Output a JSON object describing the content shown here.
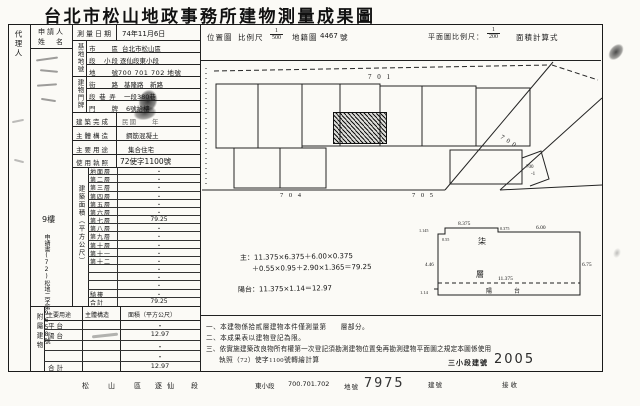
{
  "title": "台北市松山地政事務所建物測量成果圖",
  "margin": {
    "agent_label": "代理人"
  },
  "applicant": {
    "label_line1": "申請人",
    "label_line2": "姓　名",
    "floor_note": "9樓",
    "receipt": "申請書(72)松地二字第9658號"
  },
  "survey": {
    "label": "測量日期",
    "value": "74年11月6日"
  },
  "header": {
    "location_map": "位置圖",
    "scale_label": "比例尺",
    "scale_num": "1",
    "scale_den": "500",
    "cadastre_label": "地籍圖",
    "cadastre_no": "4467",
    "cadastre_unit": "號",
    "plan_scale_label": "平面圖比例尺：",
    "plan_scale_num": "1",
    "plan_scale_den": "200",
    "calc_label": "面積計算式"
  },
  "form": {
    "site_group": "基地地號",
    "site_rows": [
      {
        "label": "市　　區",
        "value": "台北市松山區"
      },
      {
        "label": "段　小段",
        "value": "逐仙段東小段"
      },
      {
        "label": "地　　號",
        "value": "700 701 702 地號"
      }
    ],
    "door_group": "建物門牌",
    "door_rows": [
      {
        "label": "街　　路",
        "value": "基隆路　新路"
      },
      {
        "label": "段 巷 弄",
        "value": "一段380巷"
      },
      {
        "label": "門　　牌",
        "value": "6號拾樓"
      }
    ],
    "built_label": "建築完成",
    "built_value": "民國　　年",
    "structure_label": "主體構造",
    "structure_value": "鋼筋混凝土",
    "use_label": "主要用途",
    "use_value": "集合住宅",
    "license_label": "使用執照",
    "license_value": "72使字1100號",
    "area_group": "建築面積（平方公尺）",
    "floors": [
      {
        "label": "地面層",
        "value": "・"
      },
      {
        "label": "第二層",
        "value": "・"
      },
      {
        "label": "第三層",
        "value": "・"
      },
      {
        "label": "第四層",
        "value": "・"
      },
      {
        "label": "第五層",
        "value": "・"
      },
      {
        "label": "第六層",
        "value": "・"
      },
      {
        "label": "第七層",
        "value": "79.25"
      },
      {
        "label": "第八層",
        "value": "・"
      },
      {
        "label": "第九層",
        "value": "・"
      },
      {
        "label": "第十層",
        "value": "・"
      },
      {
        "label": "第十一層",
        "value": "・"
      },
      {
        "label": "第十二層",
        "value": "・"
      },
      {
        "label": "",
        "value": "・"
      },
      {
        "label": "",
        "value": "・"
      },
      {
        "label": "",
        "value": "・"
      },
      {
        "label": "騎樓",
        "value": "・"
      },
      {
        "label": "合計",
        "value": "79.25"
      }
    ],
    "annex_group": "附屬建物",
    "annex_headers": [
      "主要用途",
      "主體構造",
      "面積（平方公尺）"
    ],
    "annex_rows": [
      {
        "use": "平台",
        "structure": "",
        "area": "・"
      },
      {
        "use": "陽台",
        "structure": "",
        "area": "12.97"
      },
      {
        "use": "",
        "structure": "",
        "area": "・"
      },
      {
        "use": "",
        "structure": "",
        "area": "・"
      },
      {
        "use": "合計",
        "structure": "",
        "area": "12.97"
      }
    ]
  },
  "site_plan": {
    "p701": "7 0 1",
    "p700": "7 0 0",
    "p700_1a": "700",
    "p700_1b": "-1",
    "p704": "7 0 4",
    "p705": "7 0 5"
  },
  "floor_plan": {
    "dim_top_left": "8.375",
    "dim_notch": "0.375",
    "dim_top_right": "6.00",
    "dim_right": "6.75",
    "dim_left_top": "1.145",
    "dim_left_small": "0.55",
    "dim_left_mid": "4.46",
    "dim_bottom_inner": "11.375",
    "dim_balcony": "1.14",
    "unit_char_top": "柒",
    "unit_char_bottom": "層",
    "balcony_char1": "陽",
    "balcony_char2": "台"
  },
  "calc": {
    "line1": "主：11.375×6.375＋6.00×0.375",
    "line2": "＋0.55×0.95＋2.90×1.365＝79.25",
    "line3": "陽台：11.375×1.14＝12.97"
  },
  "notes": {
    "n1": "一、本建物係拾貳層建物本件僅測量第　　層部分。",
    "n2": "二、本成果表以建物登記為限。",
    "n3": "三、依實施建築改良物所有權第一次登記須勘測建物位置免再勘測建物平面圖之規定本圖係使用",
    "n4": "執照（72）使字1100號轉繪計算",
    "bn_label": "三小段建號",
    "bn_value": "2005"
  },
  "footer": {
    "district": "松　山　區",
    "section": "逐仙　段",
    "subsection": "東小段",
    "parcels": "700.701.702",
    "parcel_unit": "地號",
    "building_no": "7975",
    "building_unit": "建號",
    "received": "接收"
  }
}
